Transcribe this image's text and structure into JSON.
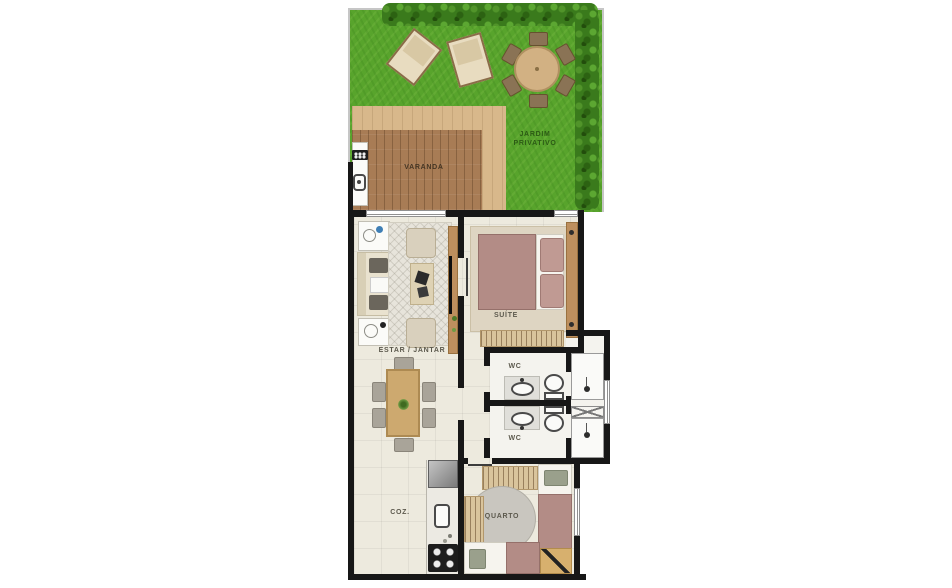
{
  "plan": {
    "labels": {
      "garden": "JARDIM\nPRIVATIVO",
      "balcony": "VARANDA",
      "living": "ESTAR / JANTAR",
      "suite": "SUÍTE",
      "wc_top": "WC",
      "wc_bottom": "WC",
      "kitchen": "COZ.",
      "bedroom": "QUARTO"
    },
    "palette": {
      "grass": "#58a42c",
      "hedge": "#3a7a1c",
      "deck_wood": "#a87c55",
      "sand_path": "#d8b88b",
      "floor": "#edeade",
      "wall": "#171717",
      "furniture_wood": "#cda96f",
      "bed_mauve": "#b38c86",
      "label_text": "#5c594d",
      "garden_label_text": "#2c5a15"
    }
  }
}
